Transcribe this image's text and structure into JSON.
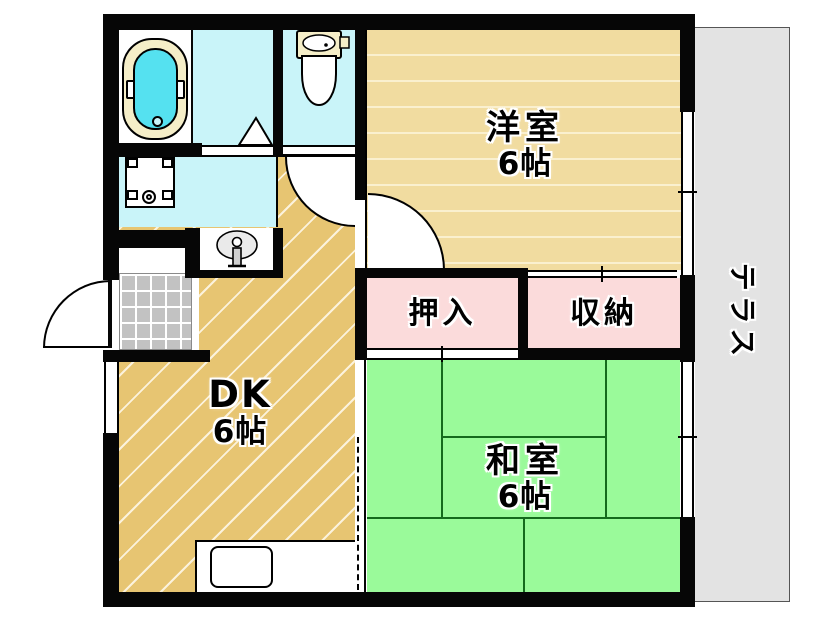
{
  "rooms": {
    "western": {
      "name": "洋室",
      "size": "6帖"
    },
    "dining_kitchen": {
      "name": "DK",
      "size": "6帖"
    },
    "japanese": {
      "name": "和室",
      "size": "6帖"
    },
    "closet": {
      "name": "押入"
    },
    "storage": {
      "name": "収納"
    },
    "terrace": {
      "name": "テラス"
    }
  },
  "fixtures": {
    "bathtub": "bathtub",
    "toilet": "toilet",
    "washing_machine_pan": "washing-machine-pan",
    "vanity_sink": "vanity-sink",
    "kitchen_sink": "kitchen-sink",
    "entrance_tile": "genkan-tile",
    "bath_door": "folding-door-triangle"
  },
  "colors": {
    "western_floor": "#F1DCA0",
    "dk_floor": "#E7C572",
    "tatami_green": "#9AFA9A",
    "closet_pink": "#FBDBDB",
    "wet_area_cyan": "#C9F4F9",
    "terrace_gray": "#E3E3E3",
    "genkan_tile_gray": "#C2C2C2",
    "bath_water": "#55E1F0",
    "tub_rim": "#F5EEC8",
    "wall": "#060606"
  }
}
